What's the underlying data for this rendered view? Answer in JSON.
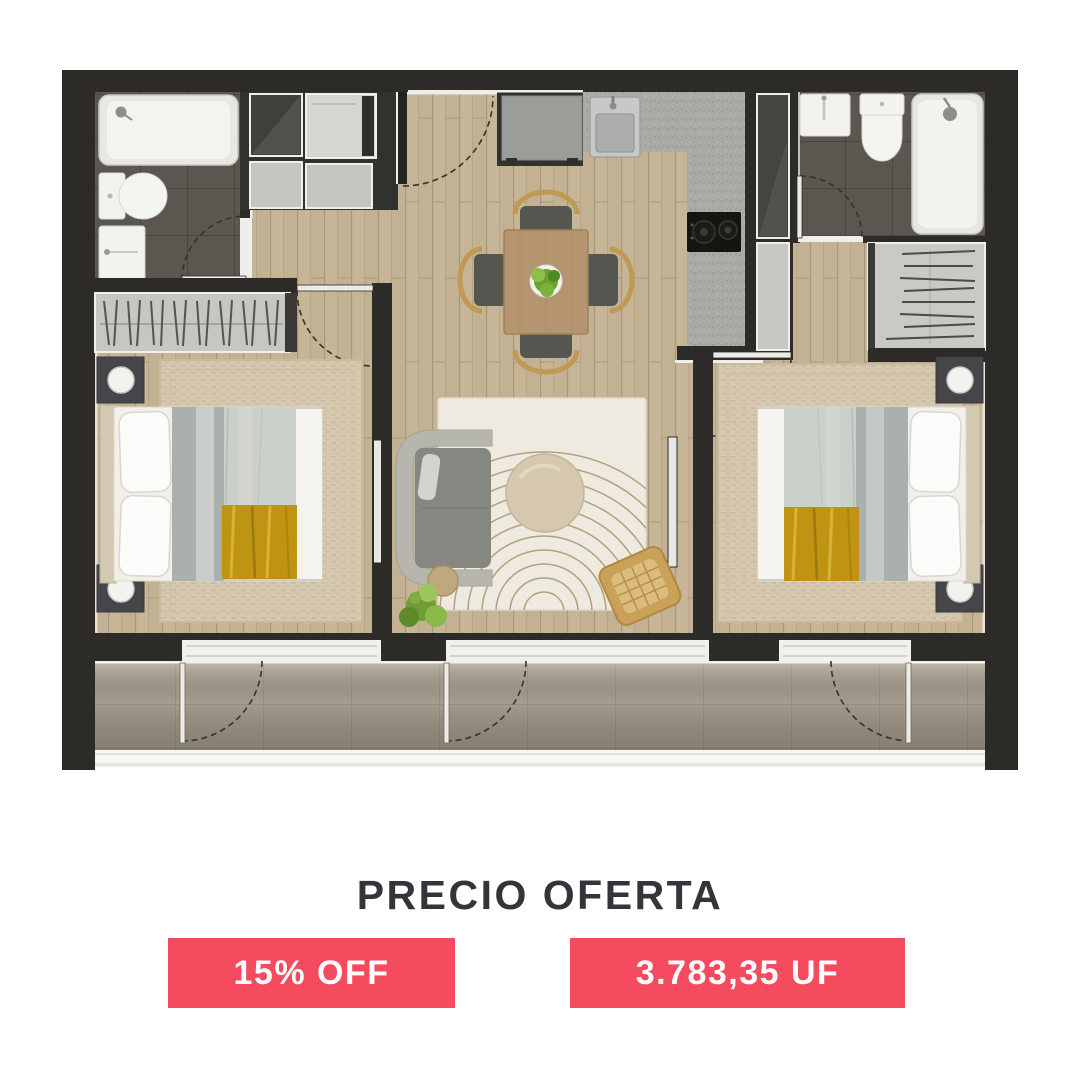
{
  "offer": {
    "title": "PRECIO OFERTA",
    "discount": "15% OFF",
    "price": "3.783,35 UF"
  },
  "colors": {
    "accent": "#f54b5e",
    "heading": "#34343a",
    "badge_text": "#ffffff",
    "background": "#ffffff",
    "wall": "#2d2b28",
    "wood_floor": "#c2b193",
    "bath_tile": "#5b5750",
    "kitchen_floor": "#a9aba5",
    "gold_throw": "#bf9413"
  }
}
